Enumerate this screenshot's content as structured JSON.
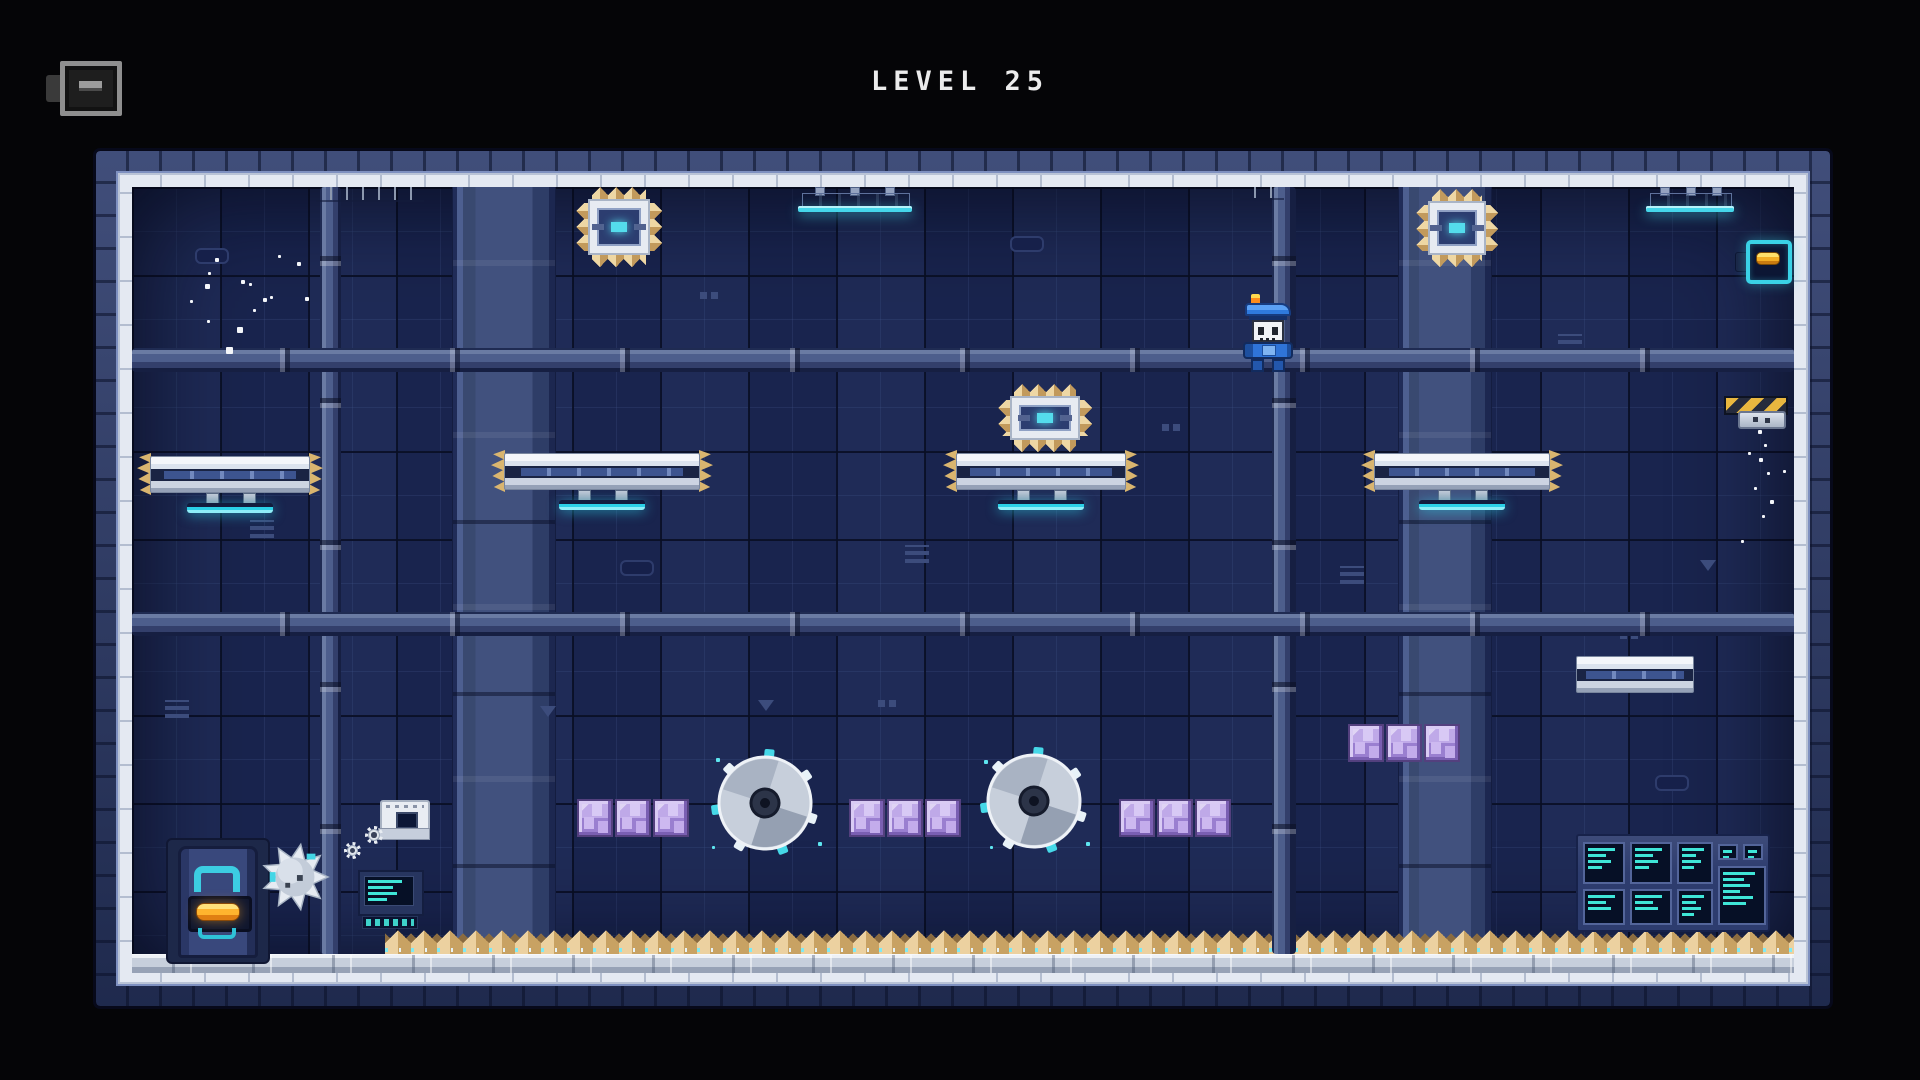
{
  "title": {
    "text": "LEVEL 25"
  },
  "hud": {
    "menu_button": {
      "icon": "menu-dash"
    }
  },
  "colors": {
    "accent_cyan": "#3fd4e6",
    "hazard_yellow": "#e9b73f",
    "crystal_purple": "#b09ae2",
    "spike_tan": "#ecd1a0",
    "player_blue": "#2f74d8",
    "wall_navy": "#1b2754",
    "frame_white": "#e4e9f2",
    "orange_item": "#ffb42e"
  },
  "scene": {
    "columns": [
      {
        "x": 452,
        "y": 187,
        "w": 102,
        "h": 767
      },
      {
        "x": 1398,
        "y": 187,
        "w": 92,
        "h": 767
      }
    ],
    "pipes_v": [
      {
        "x": 320,
        "y": 187,
        "w": 21,
        "h": 767
      },
      {
        "x": 1272,
        "y": 187,
        "w": 24,
        "h": 767
      }
    ],
    "pipes_h": [
      {
        "x": 132,
        "y": 348,
        "w": 1662,
        "h": 24
      },
      {
        "x": 132,
        "y": 612,
        "w": 1662,
        "h": 24
      }
    ],
    "rails": [
      {
        "x": 316,
        "y": 187,
        "w": 108,
        "h": 13
      },
      {
        "x": 1240,
        "y": 187,
        "w": 44,
        "h": 11
      }
    ],
    "lamps": [
      {
        "x": 802,
        "y": 187,
        "w": 106
      },
      {
        "x": 1650,
        "y": 187,
        "w": 80
      }
    ],
    "spike_blocks": [
      {
        "x": 588,
        "y": 199,
        "w": 62,
        "h": 56
      },
      {
        "x": 1428,
        "y": 201,
        "w": 58,
        "h": 54
      },
      {
        "x": 1010,
        "y": 396,
        "w": 70,
        "h": 44
      }
    ],
    "platforms": [
      {
        "x": 150,
        "y": 456,
        "w": 160,
        "stand": true,
        "brackets": true
      },
      {
        "x": 504,
        "y": 453,
        "w": 196,
        "stand": true,
        "brackets": true
      },
      {
        "x": 956,
        "y": 453,
        "w": 170,
        "stand": true,
        "brackets": true
      },
      {
        "x": 1374,
        "y": 453,
        "w": 176,
        "stand": true,
        "brackets": true
      },
      {
        "x": 1576,
        "y": 656,
        "w": 118,
        "stand": false,
        "brackets": false
      }
    ],
    "crystal_groups": [
      {
        "x": 577,
        "y": 799,
        "count": 3
      },
      {
        "x": 849,
        "y": 799,
        "count": 3
      },
      {
        "x": 1119,
        "y": 799,
        "count": 3
      },
      {
        "x": 1348,
        "y": 724,
        "count": 3
      }
    ],
    "saws": [
      {
        "cx": 765,
        "cy": 803,
        "r": 46
      },
      {
        "cx": 1034,
        "cy": 801,
        "r": 46
      }
    ],
    "spike_ball": {
      "cx": 295,
      "cy": 877,
      "r": 33
    },
    "door": {
      "x": 166,
      "y": 838
    },
    "machine": {
      "x": 380,
      "y": 800
    },
    "gears": [
      {
        "x": 365,
        "y": 826,
        "s": 18
      },
      {
        "x": 344,
        "y": 842,
        "s": 17
      }
    ],
    "terminal": {
      "x": 358,
      "y": 870
    },
    "console": {
      "x": 1576,
      "y": 834,
      "w": 190,
      "h": 94,
      "screens": [
        {
          "x": 1583,
          "y": 842,
          "w": 42,
          "h": 42,
          "lines": 4
        },
        {
          "x": 1630,
          "y": 842,
          "w": 42,
          "h": 42,
          "lines": 4
        },
        {
          "x": 1677,
          "y": 842,
          "w": 36,
          "h": 42,
          "lines": 4
        },
        {
          "x": 1718,
          "y": 844,
          "w": 20,
          "h": 16,
          "lines": 2
        },
        {
          "x": 1743,
          "y": 844,
          "w": 20,
          "h": 16,
          "lines": 2
        },
        {
          "x": 1583,
          "y": 889,
          "w": 42,
          "h": 36,
          "lines": 3
        },
        {
          "x": 1630,
          "y": 889,
          "w": 42,
          "h": 36,
          "lines": 3
        },
        {
          "x": 1677,
          "y": 889,
          "w": 36,
          "h": 36,
          "lines": 4
        },
        {
          "x": 1718,
          "y": 866,
          "w": 48,
          "h": 59,
          "lines": 6
        }
      ]
    },
    "hazard": {
      "x": 1724,
      "y": 396
    },
    "battery": {
      "x": 1735,
      "y": 240
    },
    "player": {
      "x": 1243,
      "y": 294
    },
    "floor": {
      "x": 132,
      "y": 954,
      "w": 1662,
      "h": 18,
      "spikes_x": 385,
      "spikes_w": 1409
    },
    "particles": [
      {
        "x": 215,
        "y": 258,
        "s": 4,
        "c": "w"
      },
      {
        "x": 208,
        "y": 272,
        "s": 3,
        "c": "w"
      },
      {
        "x": 205,
        "y": 284,
        "s": 5,
        "c": "w"
      },
      {
        "x": 241,
        "y": 280,
        "s": 4,
        "c": "w"
      },
      {
        "x": 249,
        "y": 283,
        "s": 3,
        "c": "w"
      },
      {
        "x": 263,
        "y": 298,
        "s": 4,
        "c": "w"
      },
      {
        "x": 270,
        "y": 296,
        "s": 3,
        "c": "w"
      },
      {
        "x": 305,
        "y": 297,
        "s": 4,
        "c": "w"
      },
      {
        "x": 207,
        "y": 320,
        "s": 3,
        "c": "w"
      },
      {
        "x": 237,
        "y": 327,
        "s": 6,
        "c": "w"
      },
      {
        "x": 226,
        "y": 347,
        "s": 7,
        "c": "w"
      },
      {
        "x": 278,
        "y": 255,
        "s": 3,
        "c": "w"
      },
      {
        "x": 297,
        "y": 262,
        "s": 4,
        "c": "w"
      },
      {
        "x": 190,
        "y": 300,
        "s": 3,
        "c": "w"
      },
      {
        "x": 253,
        "y": 309,
        "s": 3,
        "c": "w"
      },
      {
        "x": 1758,
        "y": 430,
        "s": 4,
        "c": "w"
      },
      {
        "x": 1764,
        "y": 444,
        "s": 3,
        "c": "w"
      },
      {
        "x": 1759,
        "y": 458,
        "s": 4,
        "c": "w"
      },
      {
        "x": 1767,
        "y": 472,
        "s": 3,
        "c": "w"
      },
      {
        "x": 1754,
        "y": 487,
        "s": 3,
        "c": "w"
      },
      {
        "x": 1770,
        "y": 500,
        "s": 4,
        "c": "w"
      },
      {
        "x": 1783,
        "y": 470,
        "s": 3,
        "c": "w"
      },
      {
        "x": 1748,
        "y": 452,
        "s": 3,
        "c": "w"
      },
      {
        "x": 1762,
        "y": 515,
        "s": 3,
        "c": "w"
      },
      {
        "x": 1741,
        "y": 540,
        "s": 3,
        "c": "w"
      },
      {
        "x": 716,
        "y": 758,
        "s": 4,
        "c": "c"
      },
      {
        "x": 818,
        "y": 842,
        "s": 4,
        "c": "c"
      },
      {
        "x": 984,
        "y": 760,
        "s": 4,
        "c": "c"
      },
      {
        "x": 1086,
        "y": 842,
        "s": 4,
        "c": "c"
      },
      {
        "x": 712,
        "y": 846,
        "s": 3,
        "c": "c"
      },
      {
        "x": 990,
        "y": 846,
        "s": 3,
        "c": "c"
      }
    ],
    "deco": [
      {
        "t": "vent",
        "x": 250,
        "y": 520
      },
      {
        "t": "slot",
        "x": 195,
        "y": 248
      },
      {
        "t": "dots",
        "x": 700,
        "y": 292
      },
      {
        "t": "tri",
        "x": 758,
        "y": 700
      },
      {
        "t": "vent",
        "x": 905,
        "y": 545
      },
      {
        "t": "slot",
        "x": 1010,
        "y": 236
      },
      {
        "t": "dots",
        "x": 1162,
        "y": 424
      },
      {
        "t": "vent",
        "x": 1558,
        "y": 334
      },
      {
        "t": "tri",
        "x": 1700,
        "y": 560
      },
      {
        "t": "slot",
        "x": 1655,
        "y": 775
      },
      {
        "t": "dots",
        "x": 878,
        "y": 700
      },
      {
        "t": "vent",
        "x": 1340,
        "y": 566
      },
      {
        "t": "tri",
        "x": 540,
        "y": 706
      },
      {
        "t": "slot",
        "x": 620,
        "y": 560
      },
      {
        "t": "vent",
        "x": 165,
        "y": 700
      },
      {
        "t": "dots",
        "x": 1620,
        "y": 632
      }
    ]
  }
}
